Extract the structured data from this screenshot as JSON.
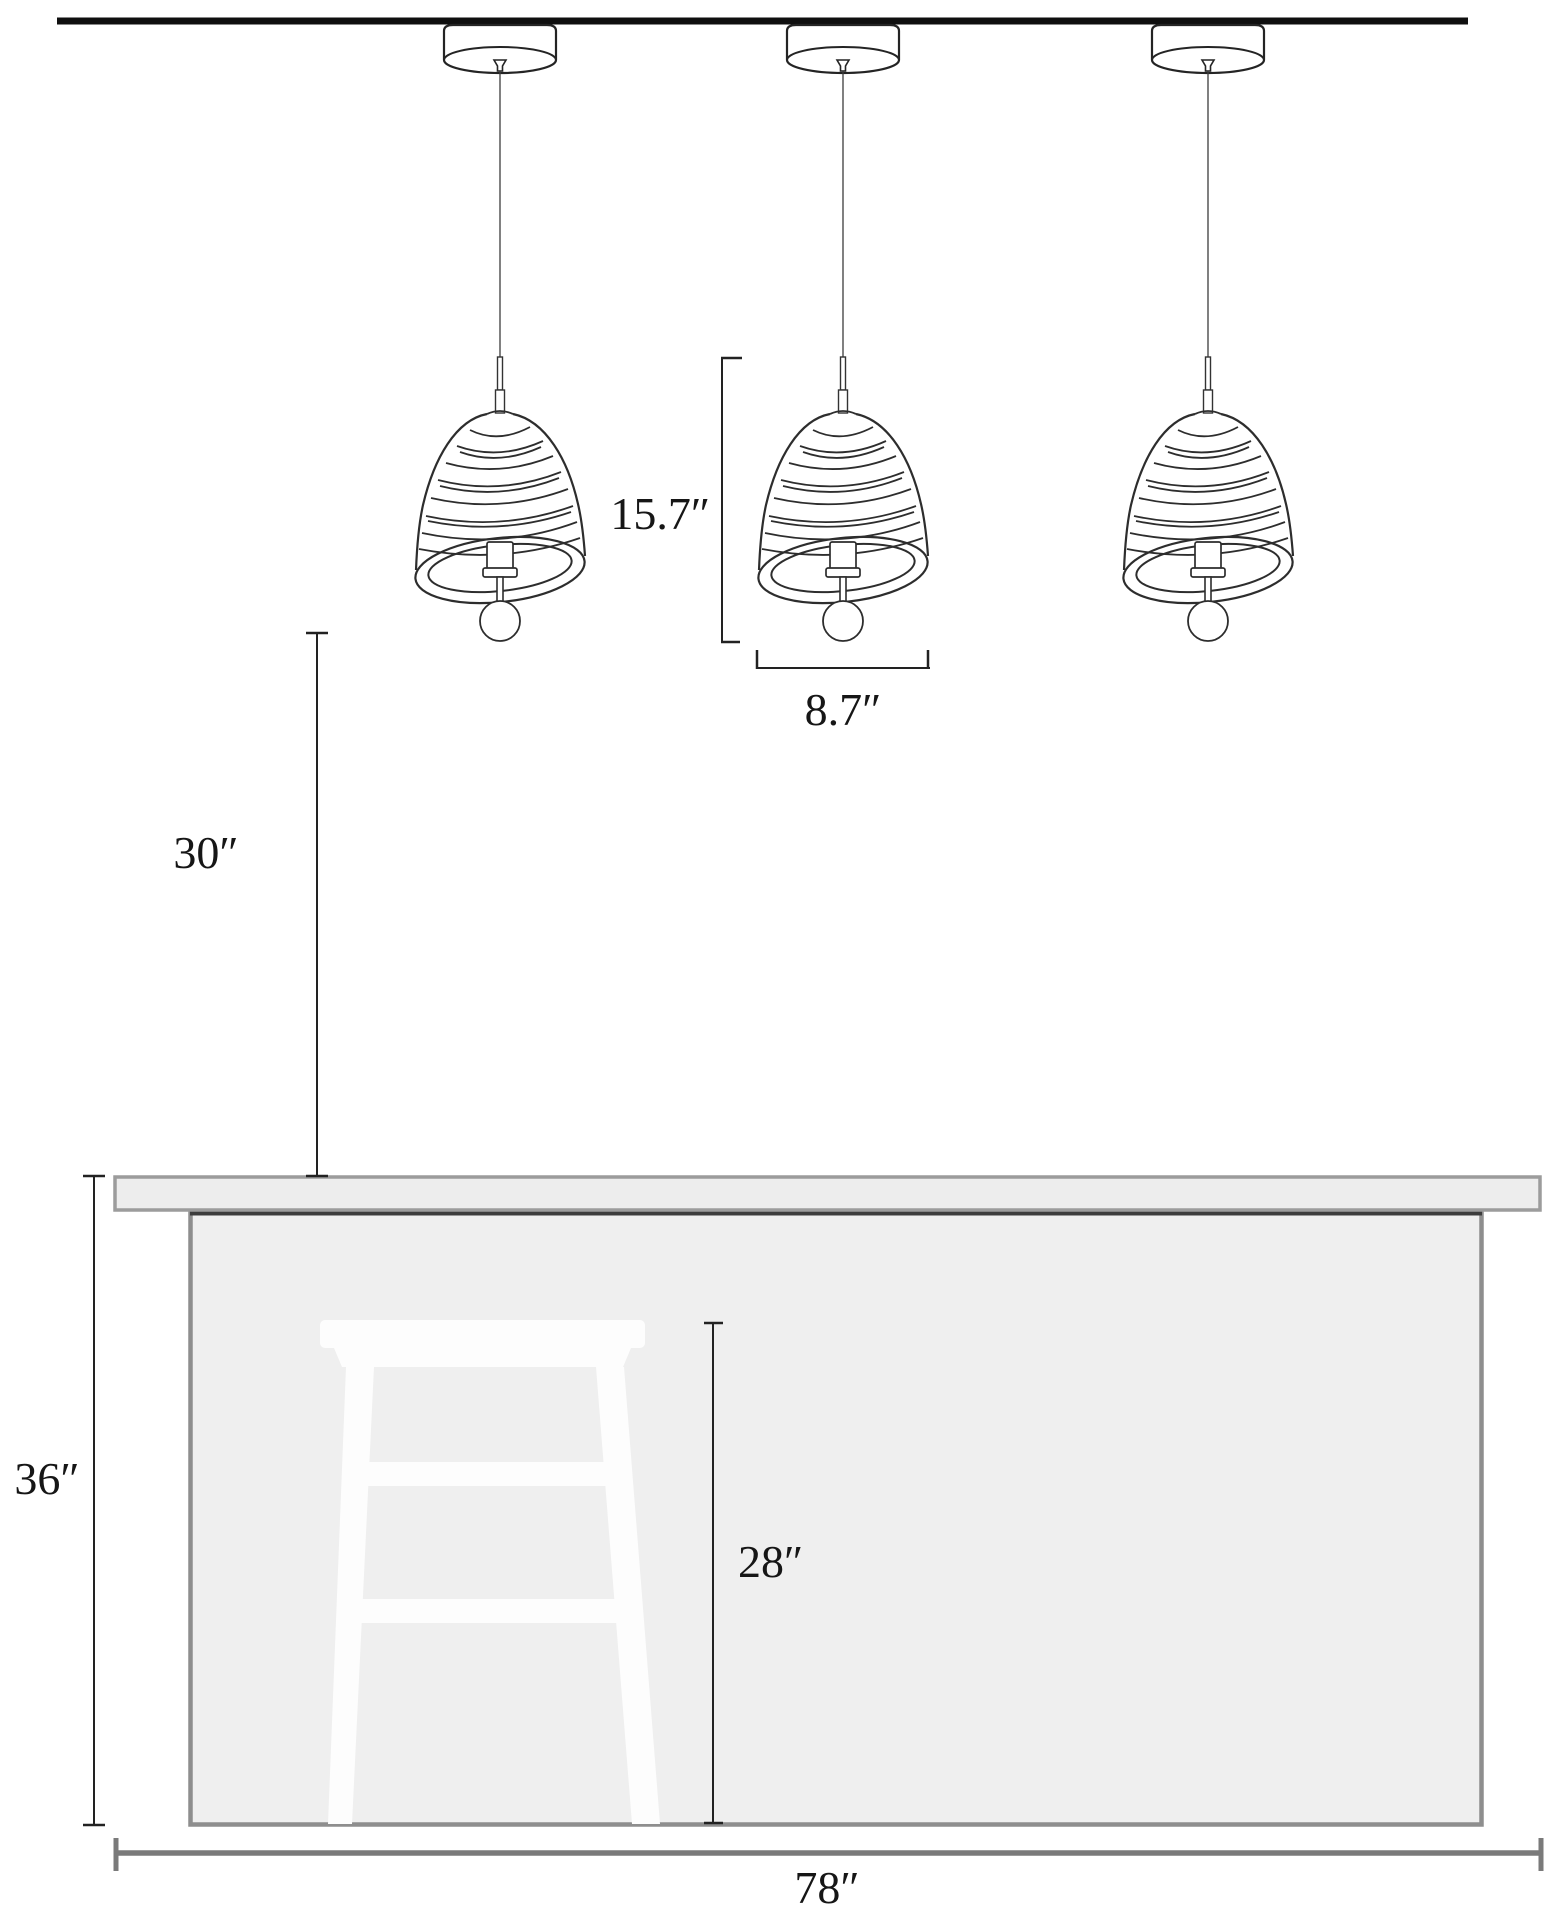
{
  "diagram": {
    "title": "Three pendant lights over kitchen island with bar stool — dimension drawing",
    "unit": "inches",
    "labels": {
      "fixture_height": "15.7″",
      "shade_width": "8.7″",
      "clearance_above_counter": "30″",
      "counter_height": "36″",
      "stool_seat_height": "28″",
      "island_width": "78″"
    },
    "dimensions_in": {
      "fixture_height": 15.7,
      "shade_width": 8.7,
      "clearance_above_counter": 30,
      "counter_height": 36,
      "stool_seat_height": 28,
      "island_width": 78
    },
    "objects": [
      "ceiling line",
      "pendant light (x3): canopy, cord, coil shade, exposed bulb",
      "kitchen island countertop",
      "kitchen island base",
      "bar stool silhouette"
    ],
    "colors": {
      "background": "#ffffff",
      "line_art": "#2a2a2a",
      "ceiling_line": "#0f0f0f",
      "dimension_line": "#222222",
      "width_dimension_line": "#7a7a7a",
      "countertop_fill": "#ededed",
      "countertop_border": "#9c9c9c",
      "island_fill": "#efefef",
      "island_border": "#8e8e8e",
      "island_shadow": "#3c3c3c",
      "stool_fill": "#fdfdfd"
    }
  }
}
